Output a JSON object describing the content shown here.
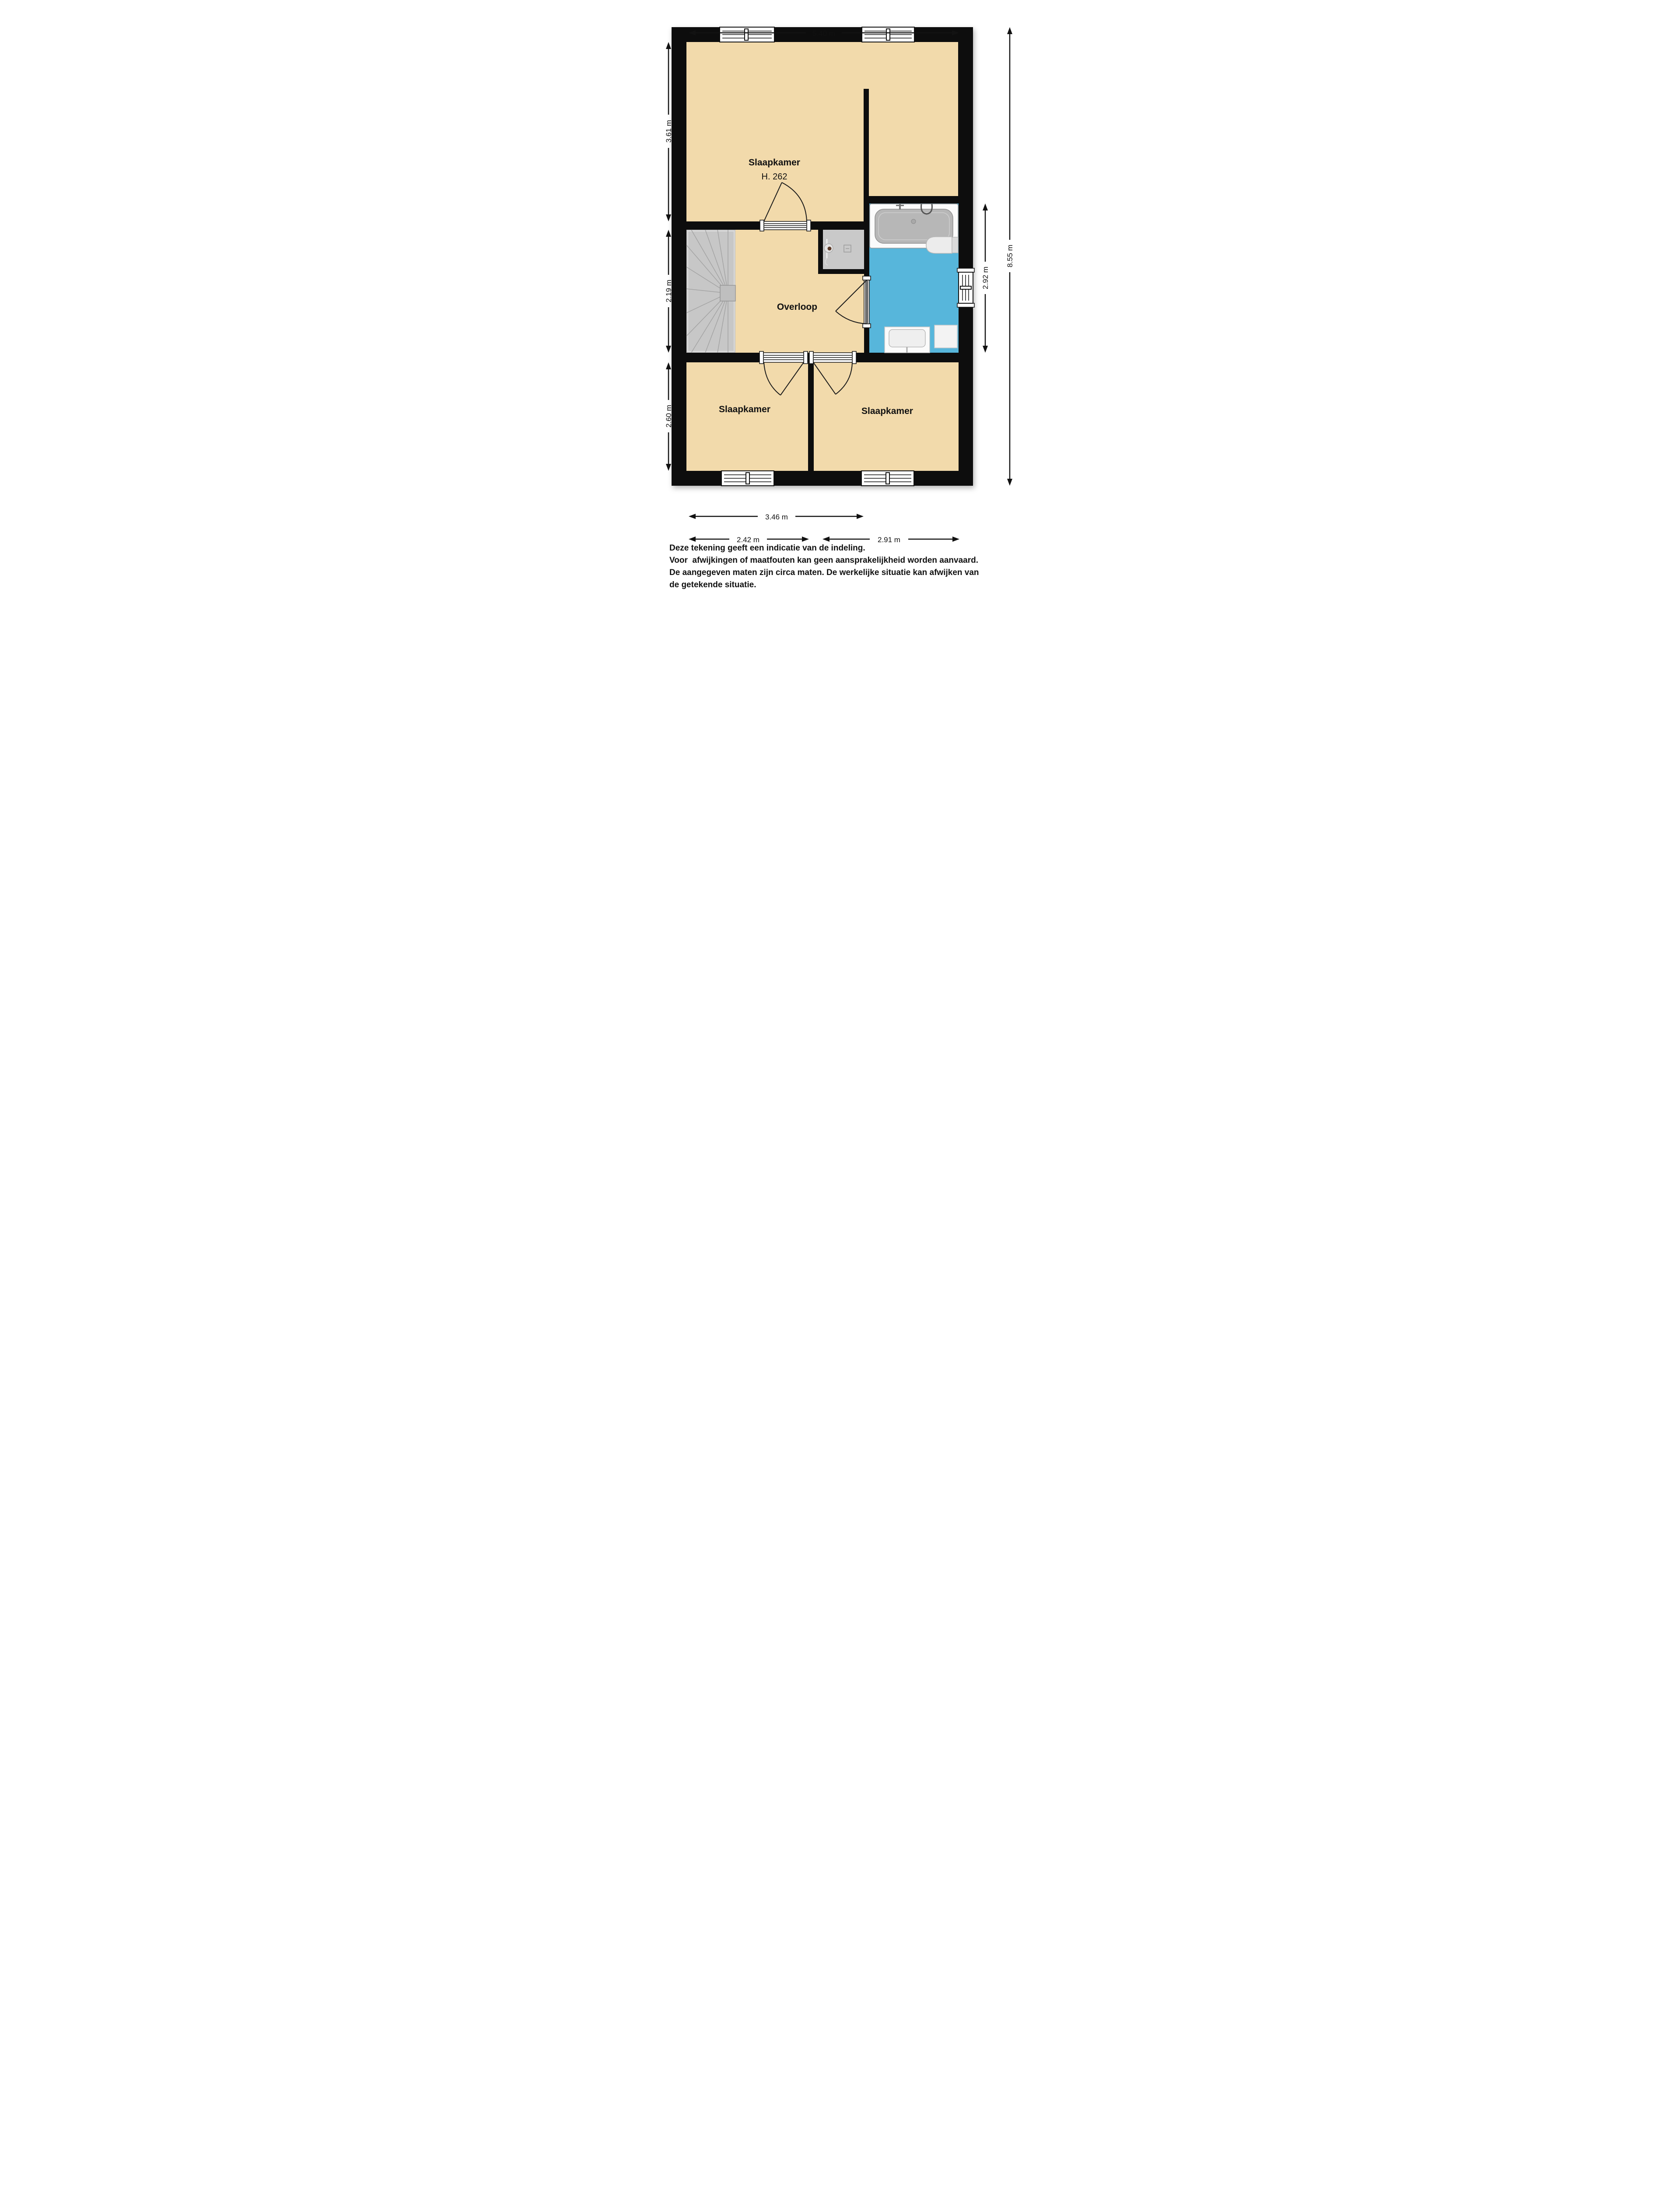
{
  "theme": {
    "wall": "#0d0d0d",
    "floor": "#F2DAAB",
    "bath": "#57B6DB",
    "shower": "#C9C9C9",
    "stairs": "#C7C7C7",
    "paper": "#FFFFFF",
    "ink": "#111111"
  },
  "rooms": {
    "bedroom_main": {
      "label": "Slaapkamer",
      "height_note": "H. 262"
    },
    "landing": {
      "label": "Overloop"
    },
    "bedroom_bottom_left": {
      "label": "Slaapkamer"
    },
    "bedroom_bottom_right": {
      "label": "Slaapkamer"
    }
  },
  "dimensions": {
    "top_width": "5.40 m",
    "left_top": "3.61 m",
    "left_middle": "2.19 m",
    "left_bottom": "2.60 m",
    "right_bath": "2.92 m",
    "right_total": "8.55 m",
    "bottom_left_total": "3.46 m",
    "bottom_left": "2.42 m",
    "bottom_right": "2.91 m"
  },
  "fixtures": [
    "staircase",
    "shower",
    "bathtub",
    "toilet",
    "washbasin",
    "bathroom-cabinet"
  ],
  "footer": {
    "lines": [
      "Deze tekening geeft een indicatie van de indeling.",
      "Voor  afwijkingen of maatfouten kan geen aansprakelijkheid worden aanvaard.",
      "De aangegeven maten zijn circa maten. De werkelijke situatie kan afwijken van",
      "de getekende situatie."
    ]
  }
}
